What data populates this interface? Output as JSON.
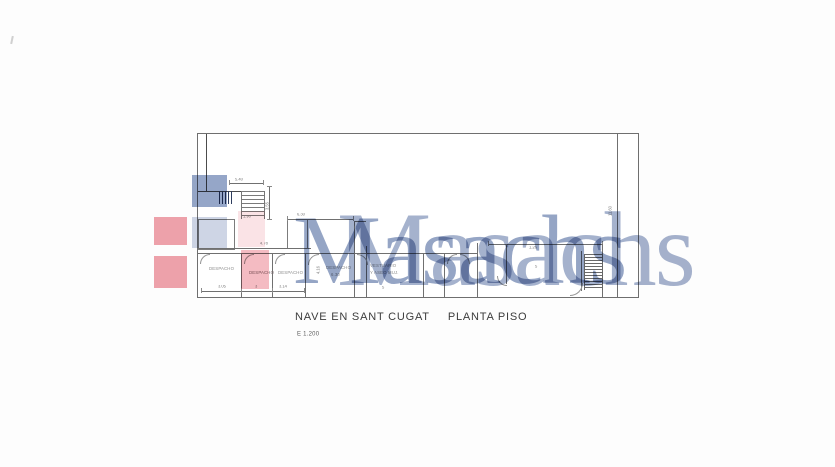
{
  "artwork": {
    "title": "NAVE  EN SANT CUGAT",
    "subtitle": "PLANTA PISO",
    "scale": "E 1.200"
  },
  "watermark": {
    "brand_front": "Masachs",
    "brand_back": "Masachs",
    "brand_color": "#7e91b8",
    "logo_blue": "#8a9cc2",
    "logo_red": "#ee9aa5",
    "highlight_pink": "#e97886"
  },
  "plan": {
    "room_labels": {
      "office1": "DESPACHO",
      "office2": "DESPACHO",
      "office3": "DESPACHO",
      "office4": "DESPACHO",
      "office4_area": "6.30",
      "vestuario_line1": "VESTUARIO",
      "vestuario_line2": "Y ASEO MUJ."
    },
    "dimensions": {
      "stair_width": "5.40",
      "stair_height": "3.55",
      "stair_small": "1.90",
      "mid_top": "6.30",
      "rooms_top": "4.78",
      "room1_width": "3.05",
      "room2_width": "3",
      "room3_width": "3.14",
      "office4_height": "4.16",
      "vest_width": "5",
      "hall_top": "1.26",
      "hall_width": "5",
      "right_height": "11.60"
    }
  }
}
